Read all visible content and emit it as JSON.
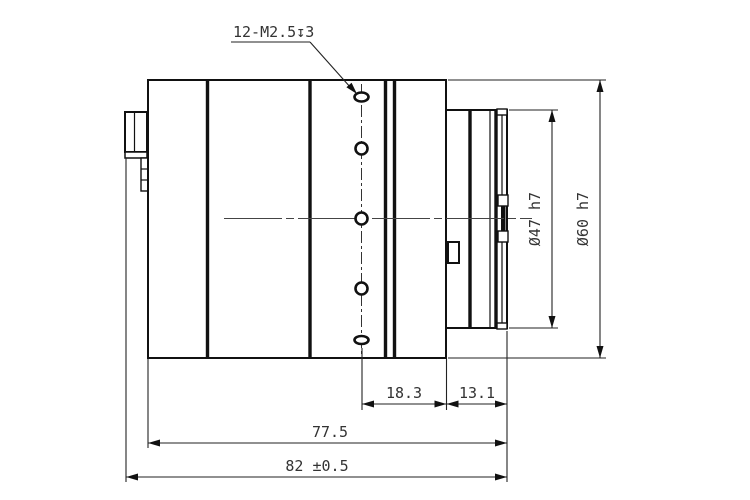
{
  "title": "lens-side-view-technical-drawing",
  "callout": {
    "thread_label": "12-M2.5↧3"
  },
  "dimensions": {
    "flange_diameter": "Ø47 h7",
    "body_diameter": "Ø60 h7",
    "holes_to_step": "18.3",
    "mount_length": "13.1",
    "body_length": "77.5",
    "total_length": "82 ±0.5"
  },
  "colors": {
    "line": "#111111",
    "dimension_line": "#222222",
    "text": "#333333",
    "background": "#ffffff"
  }
}
